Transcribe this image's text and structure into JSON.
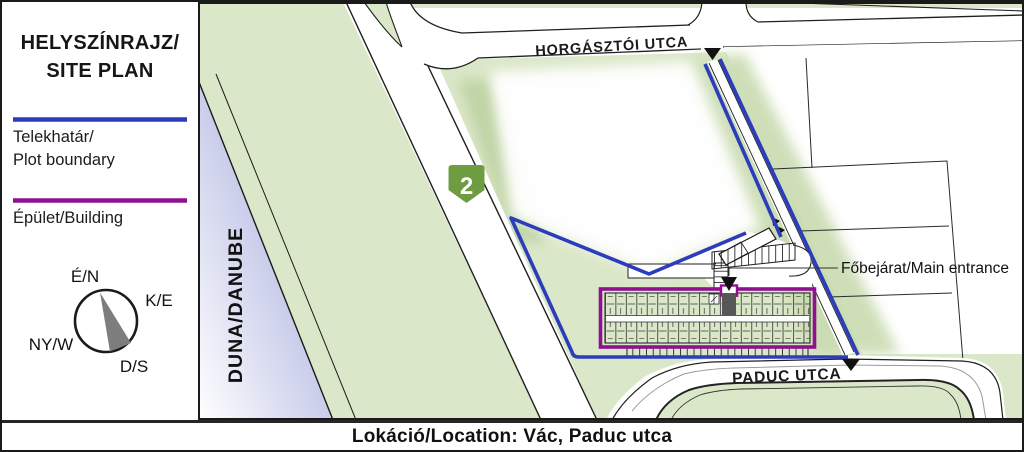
{
  "panel": {
    "title": {
      "line1": "HELYSZÍNRAJZ/",
      "line2": "SITE PLAN"
    },
    "legend": {
      "plot": {
        "line1": "Telekhatár/",
        "line2": "Plot boundary"
      },
      "building": {
        "label": "Épület/Building"
      }
    },
    "compass": {
      "north": "É/N",
      "east": "K/E",
      "west": "NY/W",
      "south": "D/S"
    }
  },
  "map": {
    "river_label": "DUNA/DANUBE",
    "street_top": "HORGÁSZTÓI UTCA",
    "street_bottom": "PADUC UTCA",
    "route_shield": "2",
    "entrance_label": "Főbejárat/Main entrance"
  },
  "footer": {
    "location": "Lokáció/Location: Vác, Paduc utca"
  },
  "colors": {
    "plot_boundary": "#2b3cbd",
    "building_outline": "#8f1190",
    "land_green": "#dbe7c9",
    "river_lavender": "#8e97d4",
    "route_shield_green": "#6d9c41",
    "compass_needle_gray": "#7d7d7d"
  }
}
